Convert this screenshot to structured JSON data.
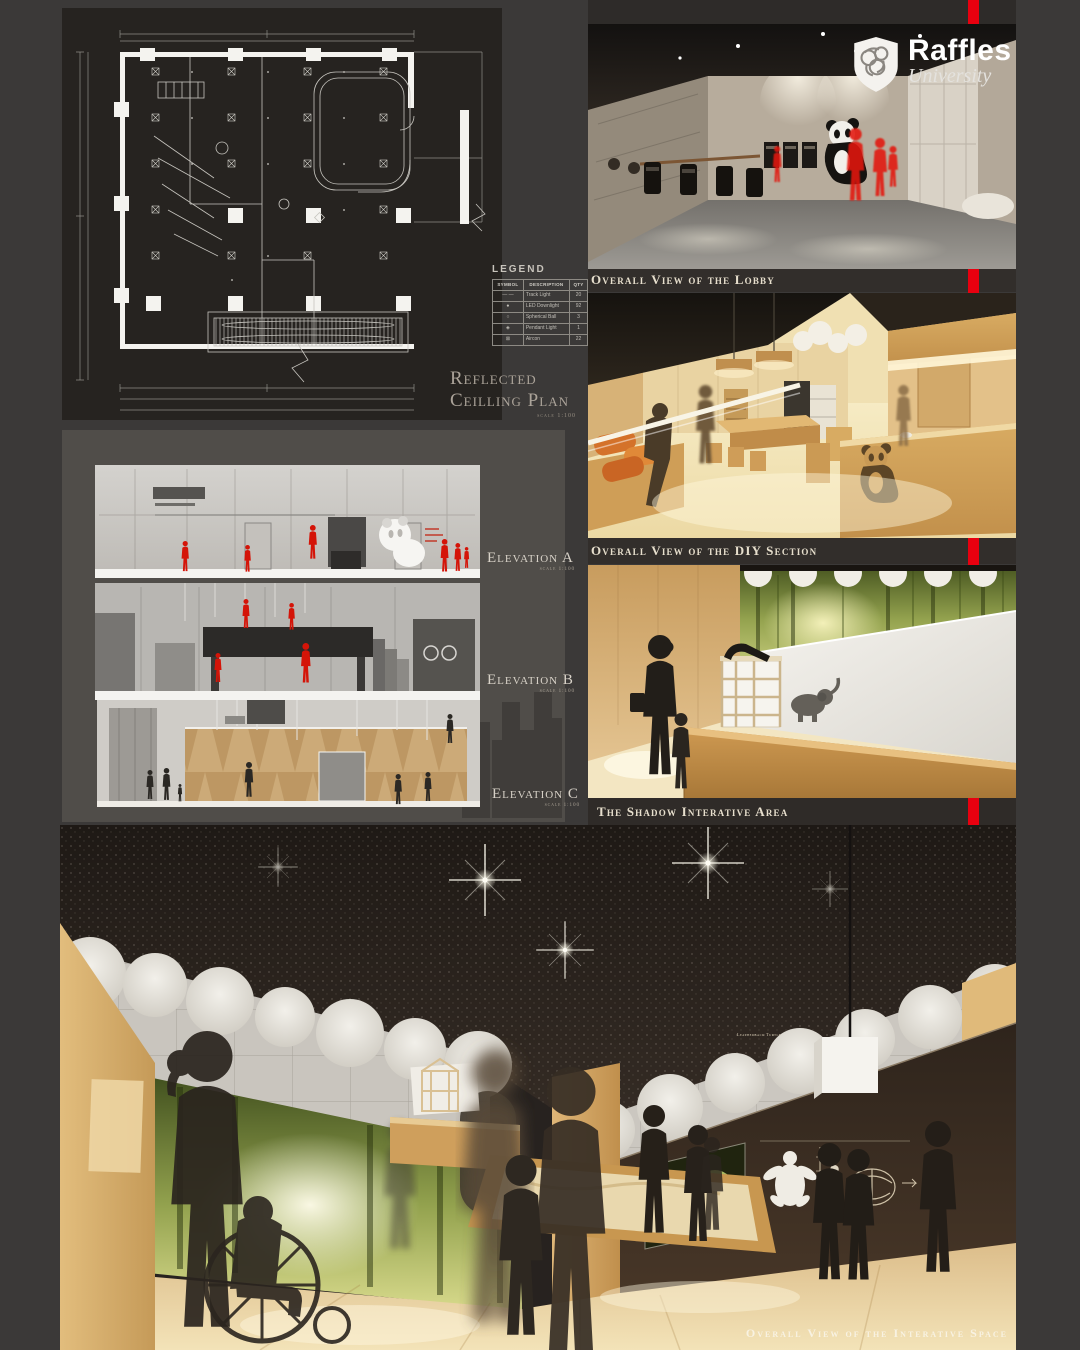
{
  "page": {
    "background": "#3b3938",
    "accent_red": "#e8000f",
    "panel_dark": "#262320",
    "panel_gray": "#504d49",
    "wood": "#d8ab62"
  },
  "logo": {
    "name": "Raffles",
    "subname": "University"
  },
  "ceiling_plan": {
    "title_line1": "Reflected",
    "title_line2": "Ceilling Plan",
    "scale": "scale 1:100",
    "legend": {
      "title": "LEGEND",
      "headers": [
        "SYMBOL",
        "DESCRIPTION",
        "QTY"
      ],
      "rows": [
        {
          "symbol": "— —",
          "desc": "Track Light",
          "qty": "20"
        },
        {
          "symbol": "●",
          "desc": "LED Downlight",
          "qty": "92"
        },
        {
          "symbol": "○",
          "desc": "Spherical Ball",
          "qty": "3"
        },
        {
          "symbol": "◈",
          "desc": "Pendant Light",
          "qty": "1"
        },
        {
          "symbol": "⊠",
          "desc": "Aircon",
          "qty": "22"
        }
      ]
    }
  },
  "elevations": [
    {
      "label": "Elevation A",
      "scale": "scale 1:100"
    },
    {
      "label": "Elevation B",
      "scale": "scale 1:100"
    },
    {
      "label": "Elevation C",
      "scale": "scale 1:100"
    }
  ],
  "captions": {
    "lobby": "Overall View of the Lobby",
    "diy": "Overall View of the DIY Section",
    "shadow": "The Shadow Interative Area",
    "interactive_space": "Overall View of the Interative Space"
  },
  "interactive_space": {
    "display_label": "Leatherback Turtle"
  }
}
